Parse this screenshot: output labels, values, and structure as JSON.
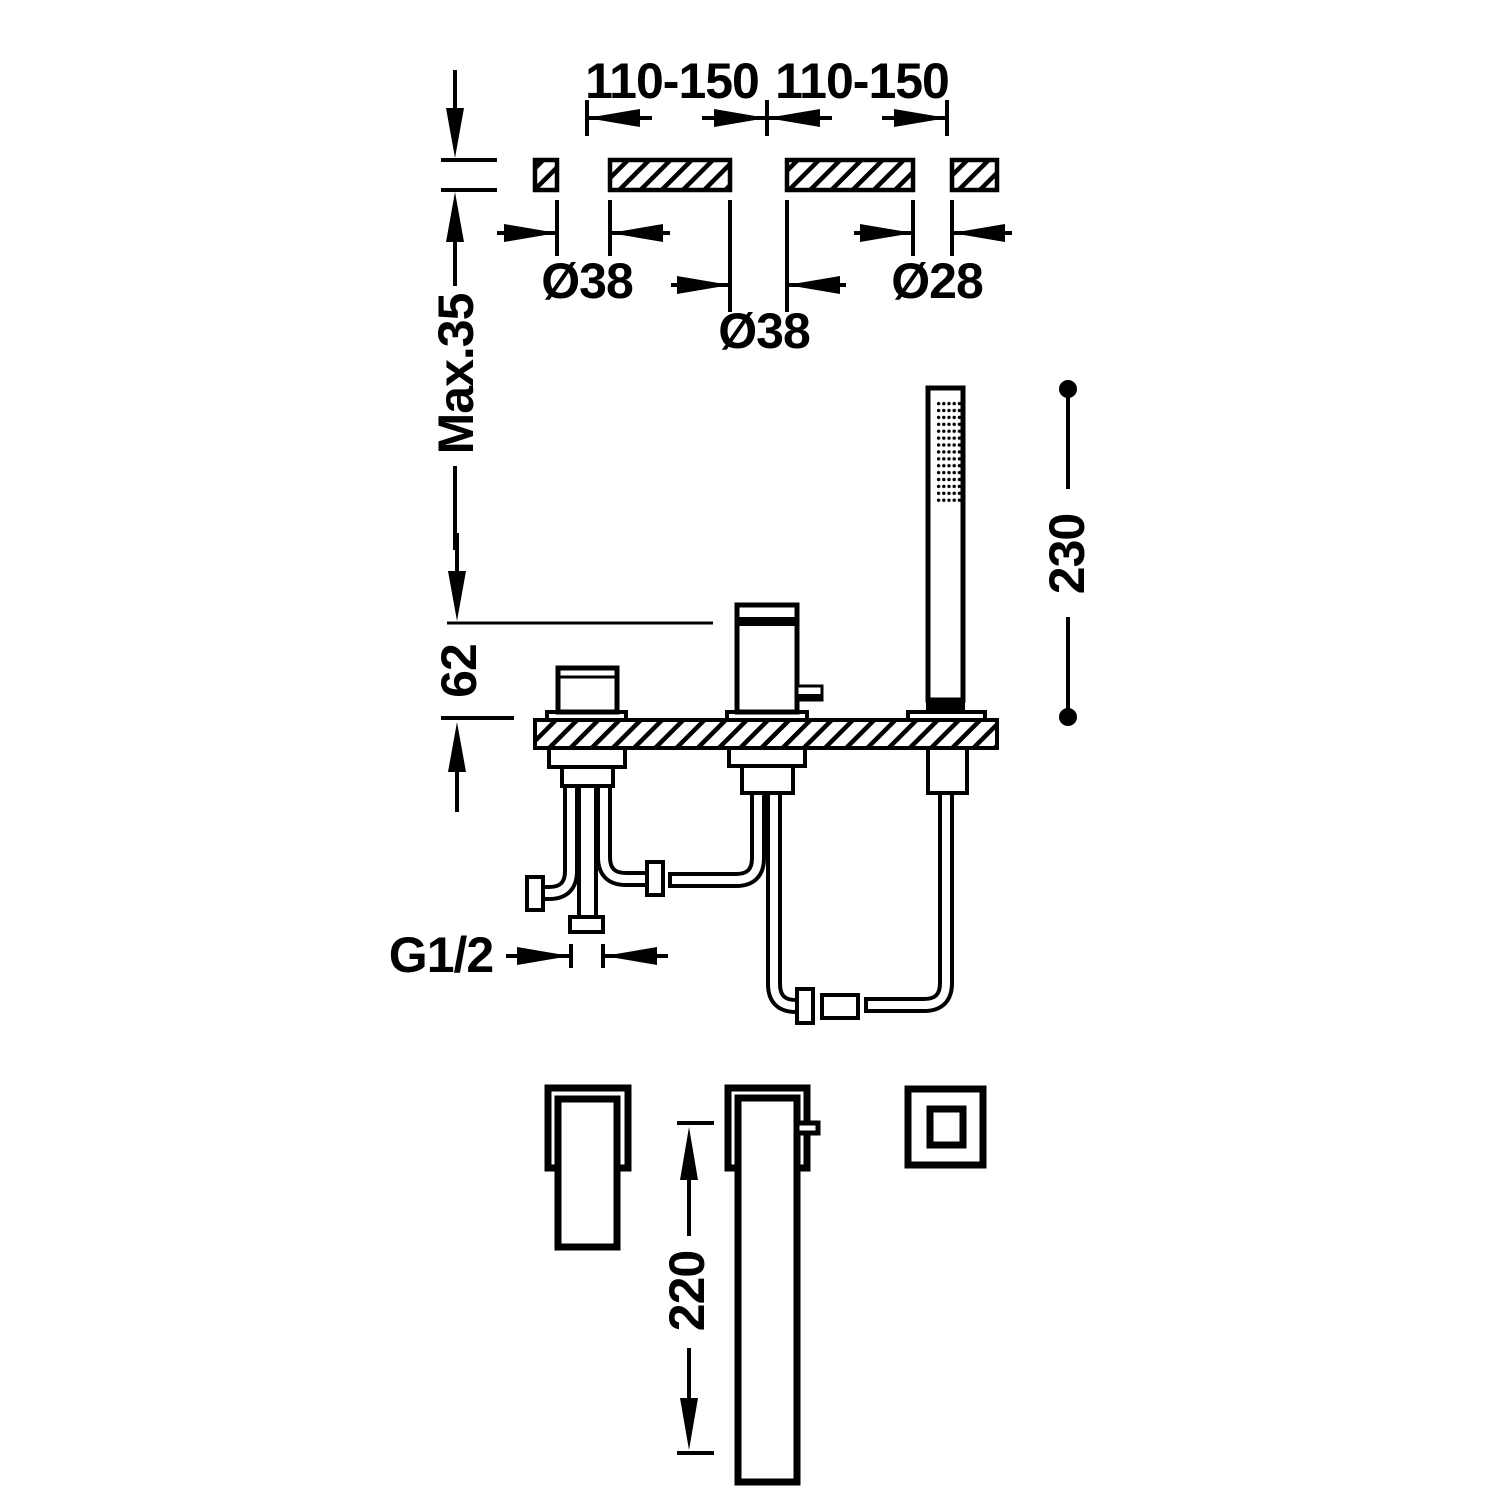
{
  "page": {
    "background_color": "#ffffff",
    "line_color": "#000000",
    "drawing_type": "deck-mounted bath mixer with handshower - dimensional drawing"
  },
  "labels": {
    "top_span_left": "110-150",
    "top_span_right": "110-150",
    "hole1_diameter": "Ø38",
    "hole2_diameter": "Ø38",
    "hole3_diameter": "Ø28",
    "countertop_thickness": "Max.35",
    "body_height": "62",
    "handshower_height": "230",
    "connection_thread": "G1/2",
    "spout_length": "220"
  }
}
